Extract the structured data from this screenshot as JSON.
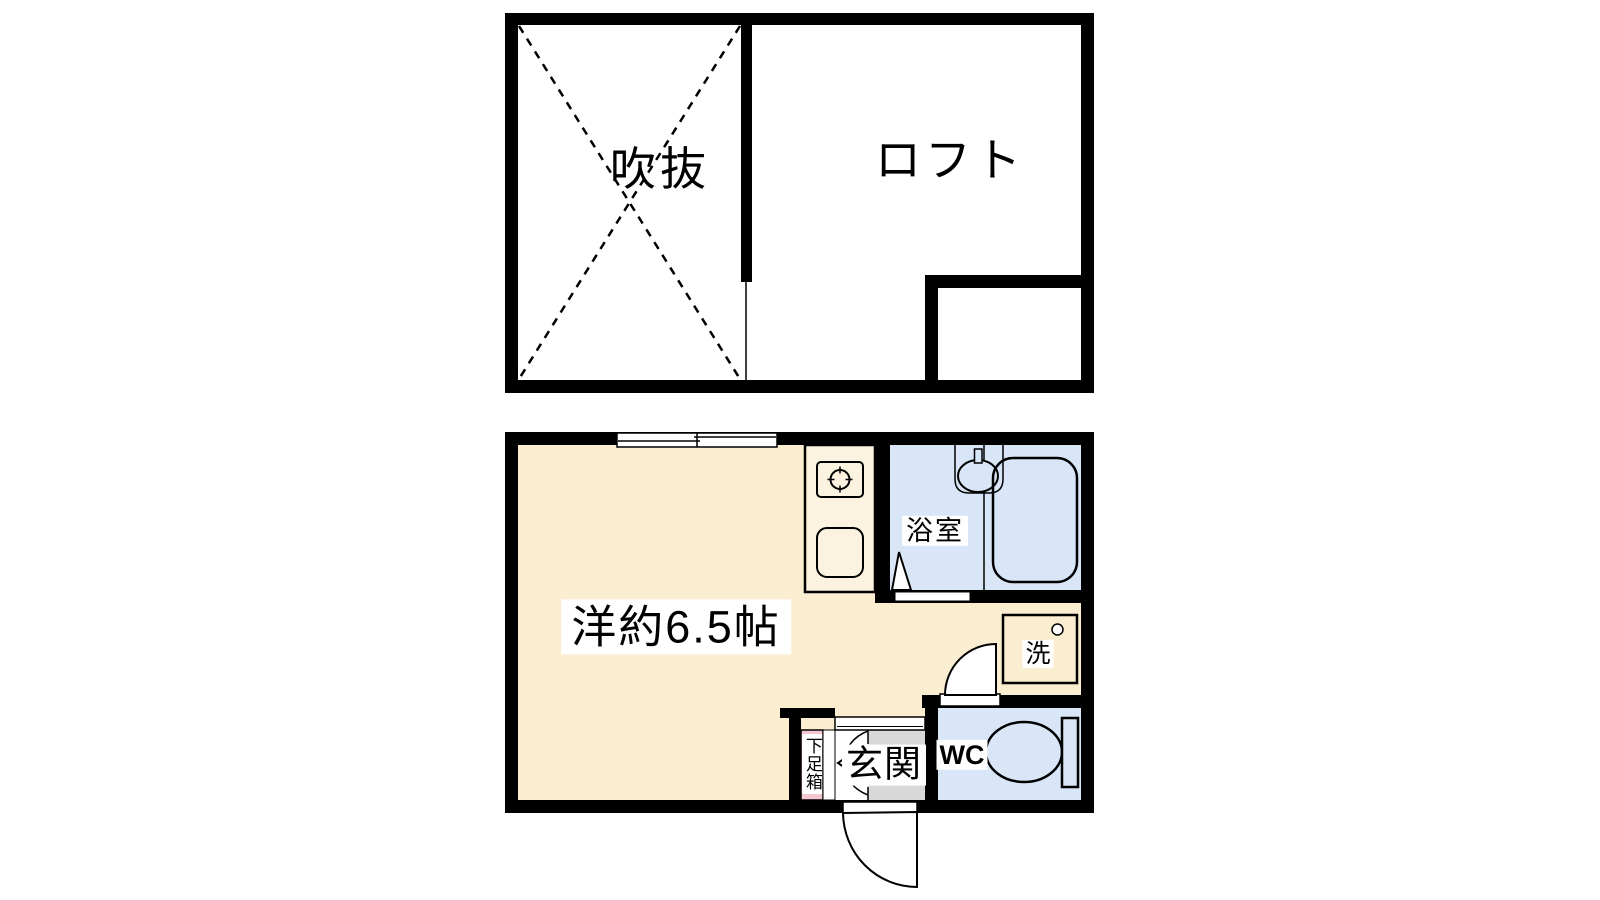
{
  "title": "apartment-floor-plan",
  "colors": {
    "wall_black": "#000000",
    "room_cream": "#FBEED0",
    "kitchen_cream": "#FBF3DF",
    "wet_area_blue": "#D9E6F7",
    "entrance_gray": "#D8D8D8",
    "shoe_box_pink": "#F6C6CE",
    "label_background": "#FFFFFF"
  },
  "upper_floor": {
    "rooms": [
      {
        "id": "void",
        "label": "吹抜"
      },
      {
        "id": "loft",
        "label": "ロフト"
      }
    ]
  },
  "lower_floor": {
    "rooms": [
      {
        "id": "main_room",
        "label": "洋約6.5帖"
      },
      {
        "id": "bathroom",
        "label": "浴室"
      },
      {
        "id": "laundry",
        "label": "洗"
      },
      {
        "id": "toilet",
        "label": "WC"
      },
      {
        "id": "entrance",
        "label": "玄関"
      },
      {
        "id": "shoe_box",
        "label": "下足箱"
      }
    ]
  }
}
